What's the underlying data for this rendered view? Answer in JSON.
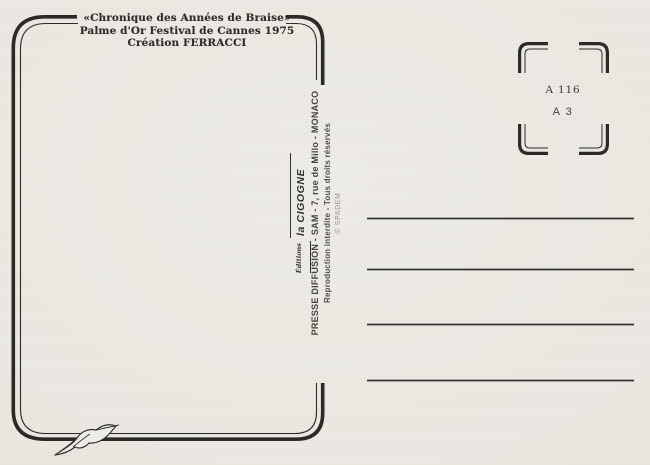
{
  "header": {
    "lines": [
      "«Chronique des Années de Braise»",
      "Palme d'Or Festival de Cannes 1975",
      "Création FERRACCI"
    ]
  },
  "publisher": {
    "editions": "Éditions",
    "name": "la CIGOGNE",
    "address_line": "PRESSE DIFFUSION - SAM - 7, rue de Millo - MONACO",
    "rights_line": "Reproduction interdite - Tous droits réservés",
    "copyright_line": "© SPADEM"
  },
  "stamp_box": {
    "code_top": "A 116",
    "code_bottom": "A 3"
  },
  "address_lines": {
    "count": 4
  },
  "icons": {
    "stork": "stork-icon",
    "frame": "picture-frame-border",
    "stamp_corners": "stamp-corner-marks"
  },
  "colors": {
    "paper": "#eae7e1",
    "ink": "#2b2a25",
    "text": "#2f2d27",
    "muted": "#98958d"
  }
}
